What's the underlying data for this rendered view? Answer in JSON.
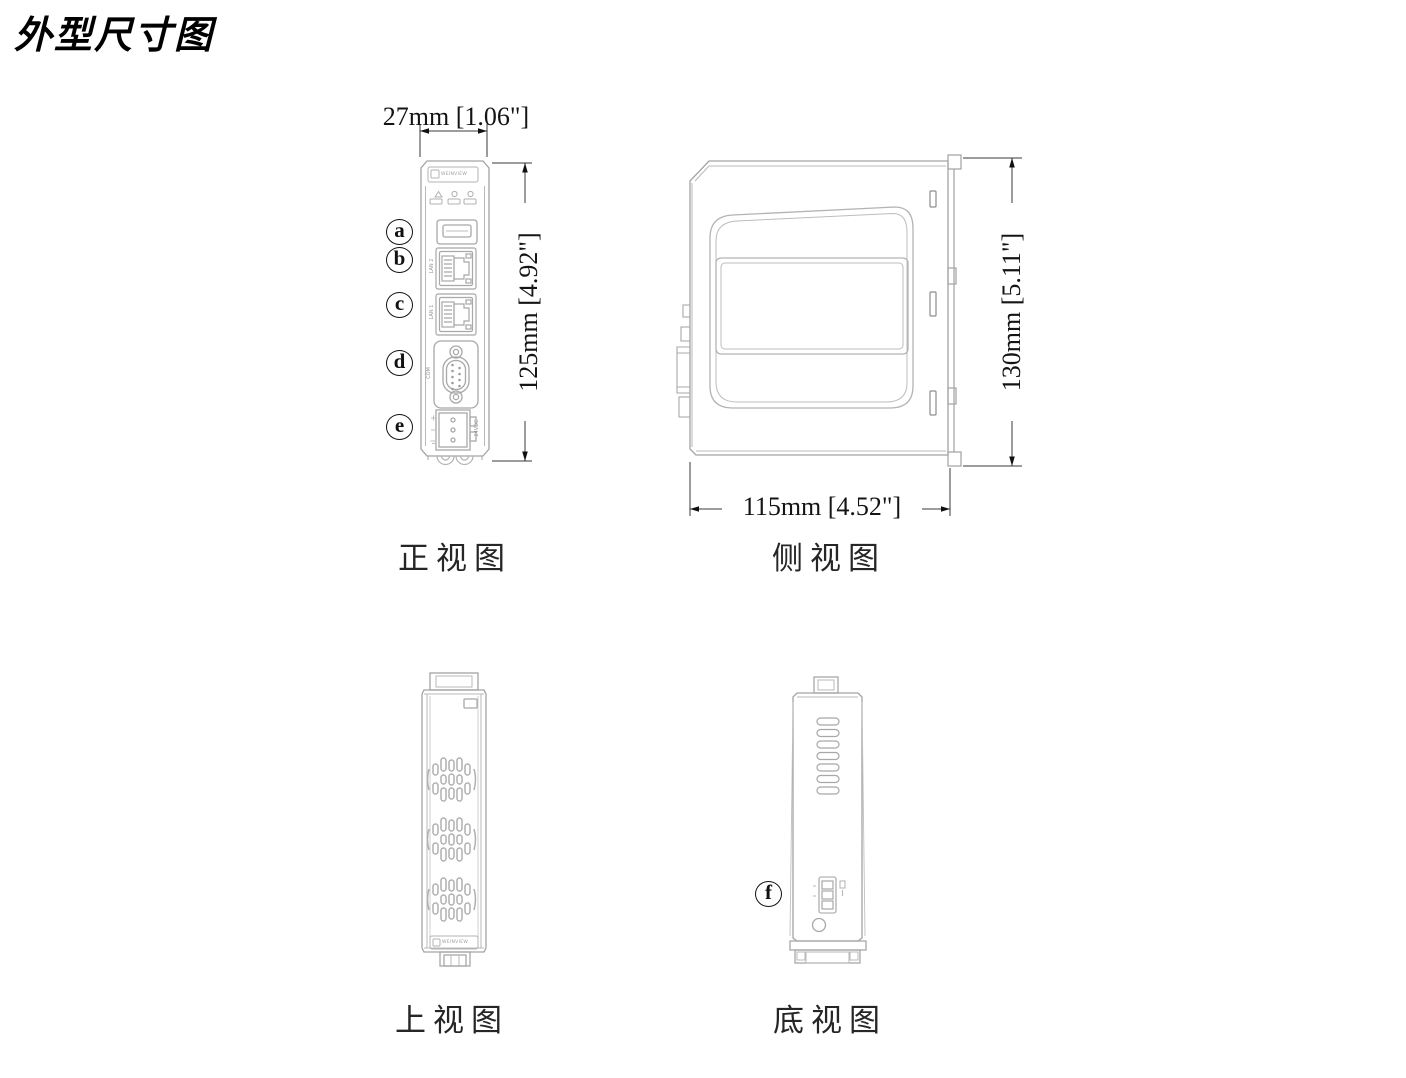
{
  "title": "外型尺寸图",
  "views": {
    "front": {
      "caption": "正视图",
      "width_dim": "27mm [1.06\"]",
      "height_dim": "125mm [4.92\"]",
      "callouts": [
        "a",
        "b",
        "c",
        "d",
        "e"
      ],
      "port_labels": {
        "lan2": "LAN 2",
        "lan1": "LAN 1",
        "com": "COM",
        "power": "24VDC"
      },
      "brand": "WEINVIEW"
    },
    "side": {
      "caption": "侧视图",
      "width_dim": "115mm [4.52\"]",
      "height_dim": "130mm [5.11\"]"
    },
    "top": {
      "caption": "上视图",
      "brand": "WEINVIEW"
    },
    "bottom": {
      "caption": "底视图",
      "callouts": [
        "f"
      ]
    }
  },
  "colors": {
    "outline": "#a3a3a3",
    "detail": "#b3b3b3",
    "dimension_line": "#3a3a3a",
    "dimension_text": "#141414"
  }
}
